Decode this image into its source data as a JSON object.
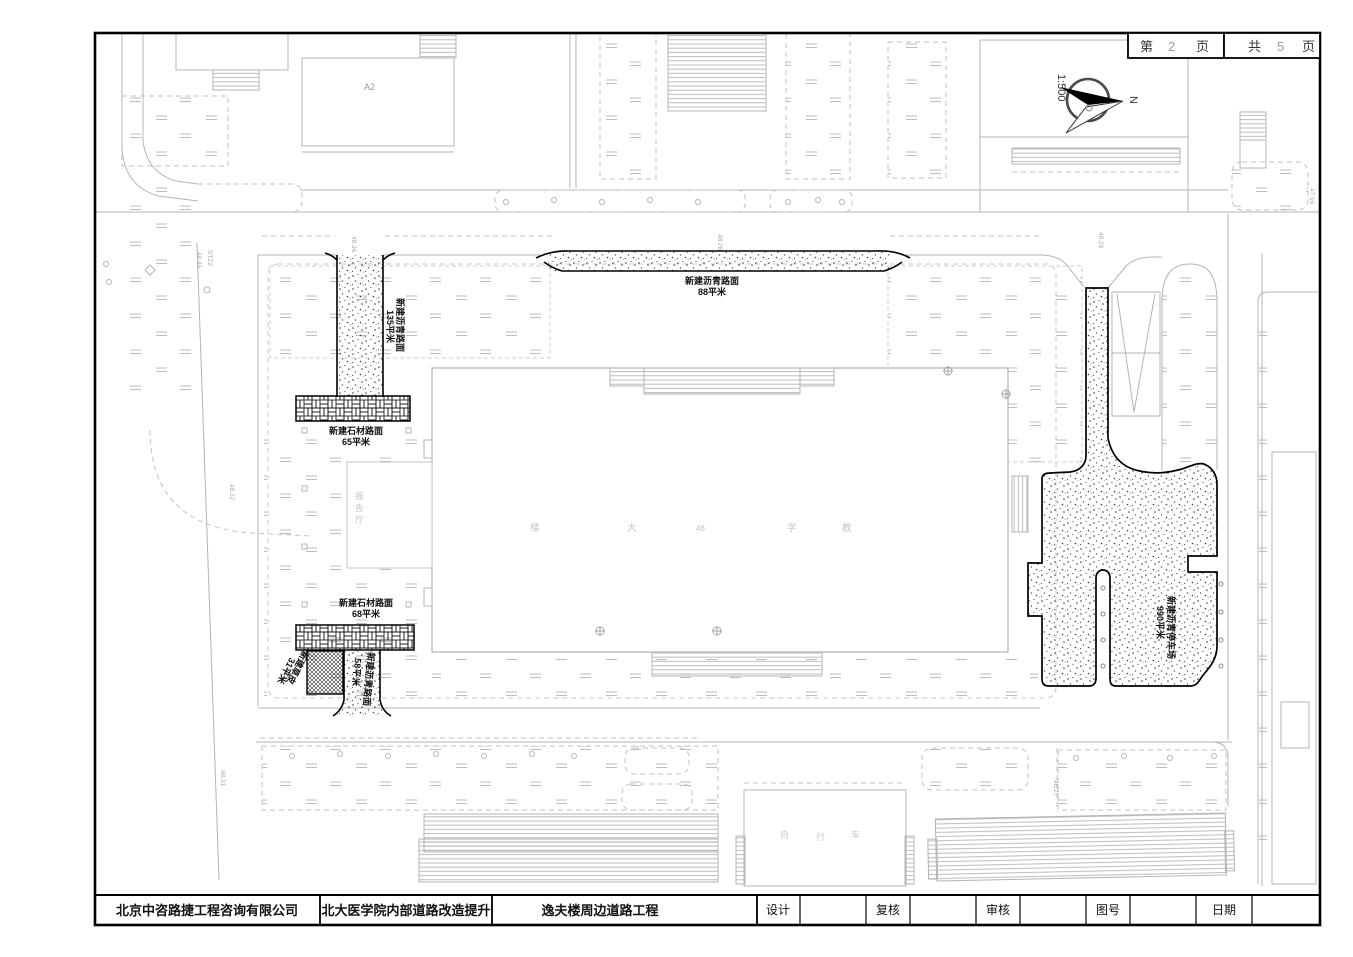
{
  "sheet": {
    "page_label_prefix": "第",
    "page_number": "2",
    "page_label_suffix": "页",
    "total_label_prefix": "共",
    "total_number": "5",
    "total_label_suffix": "页"
  },
  "north": {
    "direction_label": "N",
    "scale": "1:500"
  },
  "title_block": {
    "company": "北京中咨路捷工程咨询有限公司",
    "project": "北大医学院内部道路改造提升",
    "drawing_title": "逸夫楼周边道路工程",
    "fields": {
      "design": "设计",
      "check": "复核",
      "audit": "审核",
      "drawing_no": "图号",
      "date": "日期"
    }
  },
  "pavement_labels": {
    "asphalt_west": {
      "name": "新建沥青路面",
      "area": "135平米"
    },
    "asphalt_north": {
      "name": "新建沥青路面",
      "area": "88平米"
    },
    "stone_upper": {
      "name": "新建石材路面",
      "area": "65平米"
    },
    "stone_lower": {
      "name": "新建石材路面",
      "area": "68平米"
    },
    "turf": {
      "name": "新建草皮",
      "area": "31平米"
    },
    "asphalt_southwest": {
      "name": "新建沥青路面",
      "area": "58平米"
    },
    "parking": {
      "name": "新建沥青停车场",
      "area": "990平米"
    }
  },
  "survey_points": {
    "stz2_id": "STZ2",
    "stz2_elev": "48.45",
    "elev_top_west": "48.36",
    "elev_top_mid": "48.28",
    "elev_top_east": "48.26",
    "elev_right": "47.99",
    "elev_left_mid": "48.32",
    "elev_left_south": "48.31",
    "elev_south": "48.27"
  },
  "building_labels": {
    "a2": "A2",
    "hall_chars": [
      "报",
      "告",
      "厅"
    ],
    "main_building_chars": [
      "楼",
      "大",
      "48",
      "学",
      "教"
    ],
    "south_building_chars": [
      "自",
      "行",
      "车"
    ]
  }
}
